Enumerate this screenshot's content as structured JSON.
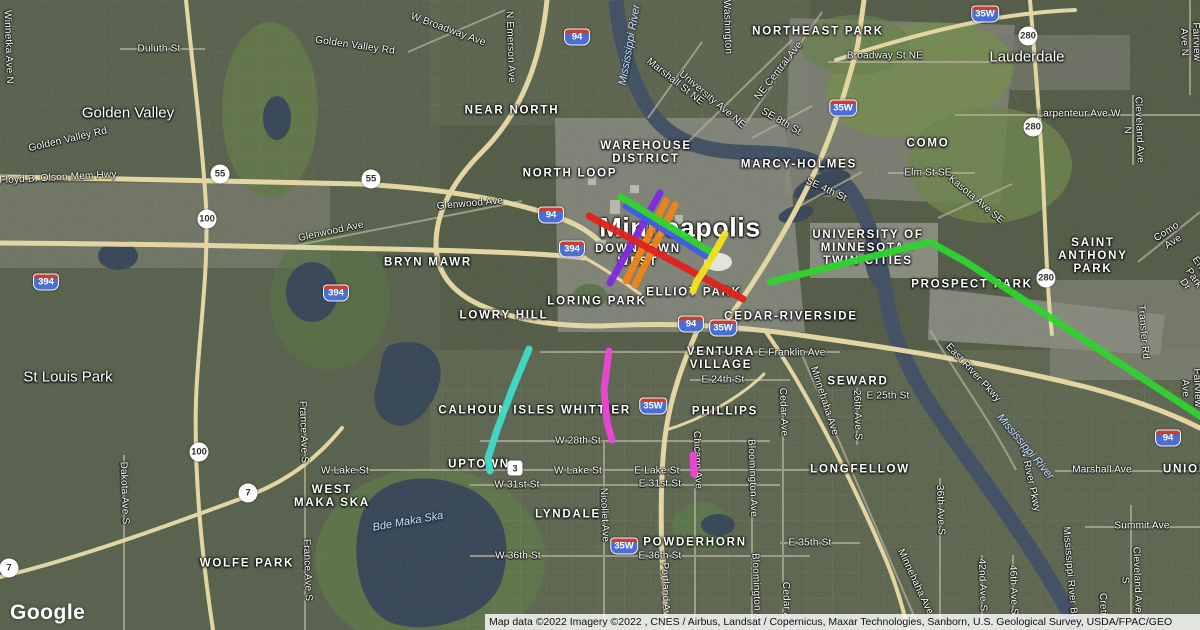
{
  "map": {
    "google_logo": "Google",
    "attribution": "Map data ©2022  Imagery ©2022 , CNES / Airbus, Landsat / Copernicus, Maxar Technologies, Sanborn, U.S. Geological Survey, USDA/FPAC/GEO",
    "big_label": {
      "text": "Minneapolis",
      "x": 680,
      "y": 228
    },
    "city_labels": [
      {
        "text": "Golden Valley",
        "x": 128,
        "y": 113
      },
      {
        "text": "Lauderdale",
        "x": 1027,
        "y": 57
      },
      {
        "text": "St Louis Park",
        "x": 68,
        "y": 377
      }
    ],
    "neighborhood_labels": [
      {
        "text": "NEAR NORTH",
        "x": 512,
        "y": 111
      },
      {
        "text": "WAREHOUSE\nDISTRICT",
        "x": 646,
        "y": 153
      },
      {
        "text": "NORTH LOOP",
        "x": 570,
        "y": 174
      },
      {
        "text": "MARCY-HOLMES",
        "x": 799,
        "y": 165
      },
      {
        "text": "NORTHEAST PARK",
        "x": 818,
        "y": 32
      },
      {
        "text": "COMO",
        "x": 928,
        "y": 144
      },
      {
        "text": "BRYN MAWR",
        "x": 428,
        "y": 263
      },
      {
        "text": "DOWNTOWN\nWEST",
        "x": 638,
        "y": 256
      },
      {
        "text": "LORING PARK",
        "x": 597,
        "y": 302
      },
      {
        "text": "ELLIOT PARK",
        "x": 694,
        "y": 293
      },
      {
        "text": "LOWRY HILL",
        "x": 504,
        "y": 316
      },
      {
        "text": "CEDAR-RIVERSIDE",
        "x": 791,
        "y": 317
      },
      {
        "text": "VENTURA\nVILLAGE",
        "x": 721,
        "y": 359
      },
      {
        "text": "UNIVERSITY OF\nMINNESOTA -\nTWIN CITIES",
        "x": 868,
        "y": 249
      },
      {
        "text": "PROSPECT PARK",
        "x": 972,
        "y": 285
      },
      {
        "text": "SAINT\nANTHONY PARK",
        "x": 1093,
        "y": 257
      },
      {
        "text": "SEWARD",
        "x": 858,
        "y": 382
      },
      {
        "text": "CALHOUN ISLES",
        "x": 497,
        "y": 411
      },
      {
        "text": "WHITTIER",
        "x": 596,
        "y": 411
      },
      {
        "text": "PHILLIPS",
        "x": 725,
        "y": 412
      },
      {
        "text": "UPTOWN",
        "x": 479,
        "y": 465
      },
      {
        "text": "WEST\nMAKA SKA",
        "x": 332,
        "y": 497
      },
      {
        "text": "LYNDALE",
        "x": 568,
        "y": 515
      },
      {
        "text": "POWDERHORN",
        "x": 695,
        "y": 543
      },
      {
        "text": "LONGFELLOW",
        "x": 860,
        "y": 470
      },
      {
        "text": "WOLFE PARK",
        "x": 247,
        "y": 564
      },
      {
        "text": "UNION",
        "x": 1186,
        "y": 470
      }
    ],
    "street_labels": [
      {
        "text": "Winnetka Ave N",
        "x": 8,
        "y": 47,
        "rot": 88
      },
      {
        "text": "Duluth St",
        "x": 159,
        "y": 49,
        "rot": 0
      },
      {
        "text": "Golden Valley Rd",
        "x": 355,
        "y": 46,
        "rot": 8
      },
      {
        "text": "Golden Valley Rd",
        "x": 68,
        "y": 140,
        "rot": -13
      },
      {
        "text": "Floyd B. Olson Mem Hwy",
        "x": 58,
        "y": 178,
        "rot": -3
      },
      {
        "text": "W Broadway Ave",
        "x": 448,
        "y": 30,
        "rot": 20
      },
      {
        "text": "N Emerson Ave",
        "x": 510,
        "y": 47,
        "rot": 88
      },
      {
        "text": "Washington",
        "x": 727,
        "y": 27,
        "rot": 88
      },
      {
        "text": "Marshall St NE",
        "x": 675,
        "y": 82,
        "rot": 38
      },
      {
        "text": "University Ave NE",
        "x": 712,
        "y": 100,
        "rot": 40
      },
      {
        "text": "NE Central Ave",
        "x": 779,
        "y": 71,
        "rot": -52
      },
      {
        "text": "SE 8th St",
        "x": 781,
        "y": 122,
        "rot": 30
      },
      {
        "text": "SE 4th St",
        "x": 826,
        "y": 190,
        "rot": 25
      },
      {
        "text": "Broadway St NE",
        "x": 885,
        "y": 56,
        "rot": 0
      },
      {
        "text": "Larpenteur Ave W",
        "x": 1079,
        "y": 114,
        "rot": 0
      },
      {
        "text": "Elm St SE",
        "x": 928,
        "y": 173,
        "rot": 0
      },
      {
        "text": "Kasota Ave SE",
        "x": 976,
        "y": 200,
        "rot": 40
      },
      {
        "text": "Fairview Ave N",
        "x": 1190,
        "y": 42,
        "rot": 88
      },
      {
        "text": "Cleveland Ave N",
        "x": 1133,
        "y": 130,
        "rot": 88
      },
      {
        "text": "Como Ave",
        "x": 1170,
        "y": 237,
        "rot": -33
      },
      {
        "text": "Energy Park Dr",
        "x": 1194,
        "y": 278,
        "rot": 55
      },
      {
        "text": "Glenwood Ave",
        "x": 331,
        "y": 232,
        "rot": -12
      },
      {
        "text": "Glenwood Ave",
        "x": 470,
        "y": 204,
        "rot": -5
      },
      {
        "text": "Transfer Rd",
        "x": 1143,
        "y": 332,
        "rot": 85
      },
      {
        "text": "East River Pkwy",
        "x": 973,
        "y": 373,
        "rot": 47
      },
      {
        "text": "E Franklin Ave",
        "x": 792,
        "y": 353,
        "rot": 0
      },
      {
        "text": "E 24th St",
        "x": 723,
        "y": 380,
        "rot": 0
      },
      {
        "text": "E 25th St",
        "x": 888,
        "y": 396,
        "rot": 0
      },
      {
        "text": "Minnehaha Ave",
        "x": 824,
        "y": 401,
        "rot": 72
      },
      {
        "text": "Minnehaha Ave",
        "x": 915,
        "y": 582,
        "rot": 65
      },
      {
        "text": "26th Ave S",
        "x": 857,
        "y": 415,
        "rot": 88
      },
      {
        "text": "Cedar Ave",
        "x": 783,
        "y": 412,
        "rot": 88
      },
      {
        "text": "Cedar Ave",
        "x": 786,
        "y": 606,
        "rot": 88
      },
      {
        "text": "W Lake St",
        "x": 345,
        "y": 471,
        "rot": 0
      },
      {
        "text": "W Lake St",
        "x": 578,
        "y": 471,
        "rot": 0
      },
      {
        "text": "E Lake St",
        "x": 657,
        "y": 471,
        "rot": 0
      },
      {
        "text": "W 28th St",
        "x": 578,
        "y": 441,
        "rot": 0
      },
      {
        "text": "W 31st St",
        "x": 517,
        "y": 485,
        "rot": 0
      },
      {
        "text": "E 31st St",
        "x": 660,
        "y": 484,
        "rot": 0
      },
      {
        "text": "W 36th St",
        "x": 518,
        "y": 556,
        "rot": 0
      },
      {
        "text": "E 36th St",
        "x": 660,
        "y": 556,
        "rot": 0
      },
      {
        "text": "E 35th St",
        "x": 810,
        "y": 543,
        "rot": 0
      },
      {
        "text": "Nicollet Ave",
        "x": 604,
        "y": 515,
        "rot": 88
      },
      {
        "text": "Portland Ave",
        "x": 665,
        "y": 592,
        "rot": 88
      },
      {
        "text": "Bloomington Ave",
        "x": 752,
        "y": 478,
        "rot": 88
      },
      {
        "text": "Bloomington Ave",
        "x": 756,
        "y": 592,
        "rot": 88
      },
      {
        "text": "Chicago Ave",
        "x": 697,
        "y": 460,
        "rot": 88
      },
      {
        "text": "Dakota Ave S",
        "x": 124,
        "y": 493,
        "rot": 88
      },
      {
        "text": "France Ave S",
        "x": 303,
        "y": 432,
        "rot": 88
      },
      {
        "text": "France Ave S",
        "x": 307,
        "y": 570,
        "rot": 88
      },
      {
        "text": "Marshall Ave",
        "x": 1102,
        "y": 470,
        "rot": 0
      },
      {
        "text": "Summit Ave",
        "x": 1142,
        "y": 526,
        "rot": 0
      },
      {
        "text": "36th Ave S",
        "x": 940,
        "y": 510,
        "rot": 88
      },
      {
        "text": "42nd Ave S",
        "x": 982,
        "y": 585,
        "rot": 88
      },
      {
        "text": "46th Ave S",
        "x": 1013,
        "y": 590,
        "rot": 88
      },
      {
        "text": "Cleveland Ave S",
        "x": 1131,
        "y": 580,
        "rot": 88
      },
      {
        "text": "Cretin Ave",
        "x": 1103,
        "y": 617,
        "rot": 88
      },
      {
        "text": "Mississippi River Blvd",
        "x": 1070,
        "y": 577,
        "rot": 85
      },
      {
        "text": "W River Pkwy",
        "x": 1030,
        "y": 480,
        "rot": 78
      },
      {
        "text": "Fairview Ave",
        "x": 1191,
        "y": 388,
        "rot": 88
      }
    ],
    "water_labels": [
      {
        "text": "Mississippi River",
        "x": 630,
        "y": 45,
        "rot": -80
      },
      {
        "text": "Mississippi River",
        "x": 1025,
        "y": 447,
        "rot": 50
      },
      {
        "text": "Bde Maka Ska",
        "x": 408,
        "y": 522,
        "rot": -10
      }
    ],
    "interstate_shields": [
      {
        "label": "94",
        "x": 577,
        "y": 37
      },
      {
        "label": "94",
        "x": 551,
        "y": 215
      },
      {
        "label": "94",
        "x": 691,
        "y": 324
      },
      {
        "label": "94",
        "x": 1168,
        "y": 438
      },
      {
        "label": "394",
        "x": 46,
        "y": 282
      },
      {
        "label": "394",
        "x": 336,
        "y": 293
      },
      {
        "label": "394",
        "x": 572,
        "y": 249
      },
      {
        "label": "35W",
        "x": 985,
        "y": 14
      },
      {
        "label": "35W",
        "x": 843,
        "y": 108
      },
      {
        "label": "35W",
        "x": 723,
        "y": 328
      },
      {
        "label": "35W",
        "x": 653,
        "y": 406
      },
      {
        "label": "35W",
        "x": 624,
        "y": 546
      }
    ],
    "circle_shields": [
      {
        "label": "55",
        "x": 220,
        "y": 174
      },
      {
        "label": "55",
        "x": 371,
        "y": 179
      },
      {
        "label": "100",
        "x": 207,
        "y": 219
      },
      {
        "label": "100",
        "x": 199,
        "y": 452
      },
      {
        "label": "280",
        "x": 1028,
        "y": 36
      },
      {
        "label": "280",
        "x": 1033,
        "y": 127
      },
      {
        "label": "280",
        "x": 1046,
        "y": 278
      },
      {
        "label": "7",
        "x": 248,
        "y": 493
      },
      {
        "label": "7",
        "x": 9,
        "y": 568
      }
    ],
    "square_shields": [
      {
        "label": "3",
        "x": 515,
        "y": 468
      }
    ],
    "transit_lines": [
      {
        "id": "purple-line",
        "color": "#7f28e0",
        "width": 7,
        "points": [
          [
            660,
            193
          ],
          [
            610,
            283
          ]
        ]
      },
      {
        "id": "orange-line-a",
        "color": "#f08418",
        "width": 7,
        "points": [
          [
            666,
            201
          ],
          [
            626,
            281
          ]
        ]
      },
      {
        "id": "orange-line-b",
        "color": "#f08418",
        "width": 7,
        "points": [
          [
            675,
            205
          ],
          [
            635,
            285
          ]
        ]
      },
      {
        "id": "blue-line",
        "color": "#3d5be8",
        "width": 7,
        "points": [
          [
            626,
            206
          ],
          [
            710,
            258
          ]
        ]
      },
      {
        "id": "green-line-downtown",
        "color": "#2fd42f",
        "width": 7,
        "points": [
          [
            621,
            197
          ],
          [
            714,
            254
          ]
        ]
      },
      {
        "id": "red-line",
        "color": "#e3211a",
        "width": 7,
        "points": [
          [
            589,
            216
          ],
          [
            743,
            299
          ]
        ]
      },
      {
        "id": "yellow-line",
        "color": "#f2e41e",
        "width": 7,
        "points": [
          [
            725,
            234
          ],
          [
            708,
            264
          ],
          [
            697,
            281
          ],
          [
            693,
            291
          ]
        ]
      },
      {
        "id": "teal-line",
        "color": "#40dcc8",
        "width": 7,
        "points": [
          [
            529,
            349
          ],
          [
            512,
            390
          ],
          [
            497,
            430
          ],
          [
            488,
            458
          ],
          [
            490,
            471
          ]
        ]
      },
      {
        "id": "magenta-line-whittier",
        "color": "#ef45d8",
        "width": 7,
        "points": [
          [
            609,
            351
          ],
          [
            604,
            390
          ],
          [
            607,
            422
          ],
          [
            612,
            440
          ]
        ]
      },
      {
        "id": "magenta-line-chicago",
        "color": "#ef45d8",
        "width": 7,
        "points": [
          [
            693,
            455
          ],
          [
            694,
            474
          ]
        ]
      },
      {
        "id": "green-line-university",
        "color": "#2fd42f",
        "width": 7,
        "points": [
          [
            770,
            282
          ],
          [
            930,
            242
          ],
          [
            966,
            262
          ],
          [
            1200,
            416
          ]
        ]
      }
    ]
  }
}
